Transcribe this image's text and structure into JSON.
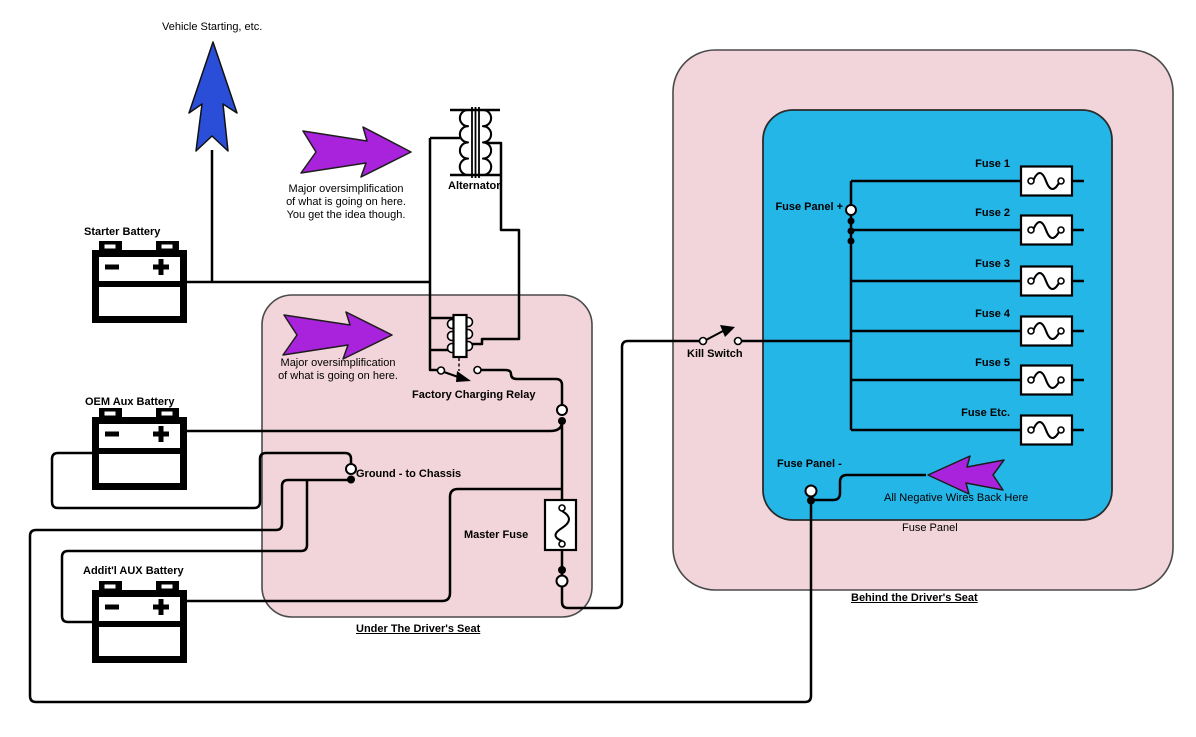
{
  "colors": {
    "zone_pink": "#f2d5da",
    "fuse_panel_cyan": "#25b6e8",
    "callout_purple": "#a923dc",
    "starting_arrow_blue": "#2b4ed8",
    "wire_black": "#000000"
  },
  "annotations": {
    "vehicle_starting": "Vehicle Starting, etc.",
    "note_top": "Major oversimplification\nof what is going on here.\nYou get the idea though.",
    "note_box": "Major oversimplification\nof what is going on here.",
    "all_negative": "All Negative Wires Back Here"
  },
  "components": {
    "starter_battery": "Starter Battery",
    "alternator": "Alternator",
    "factory_relay": "Factory Charging Relay",
    "oem_battery": "OEM Aux Battery",
    "ground": "Ground - to Chassis",
    "master_fuse": "Master Fuse",
    "additl_battery": "Addit'l AUX Battery",
    "kill_switch": "Kill Switch"
  },
  "zones": {
    "under_seat": "Under The Driver's Seat",
    "behind_seat": "Behind the Driver's Seat",
    "fuse_panel_caption": "Fuse Panel"
  },
  "fuse_panel": {
    "plus_label": "Fuse Panel +",
    "minus_label": "Fuse Panel -",
    "fuses": [
      "Fuse 1",
      "Fuse 2",
      "Fuse 3",
      "Fuse 4",
      "Fuse 5",
      "Fuse Etc."
    ]
  }
}
